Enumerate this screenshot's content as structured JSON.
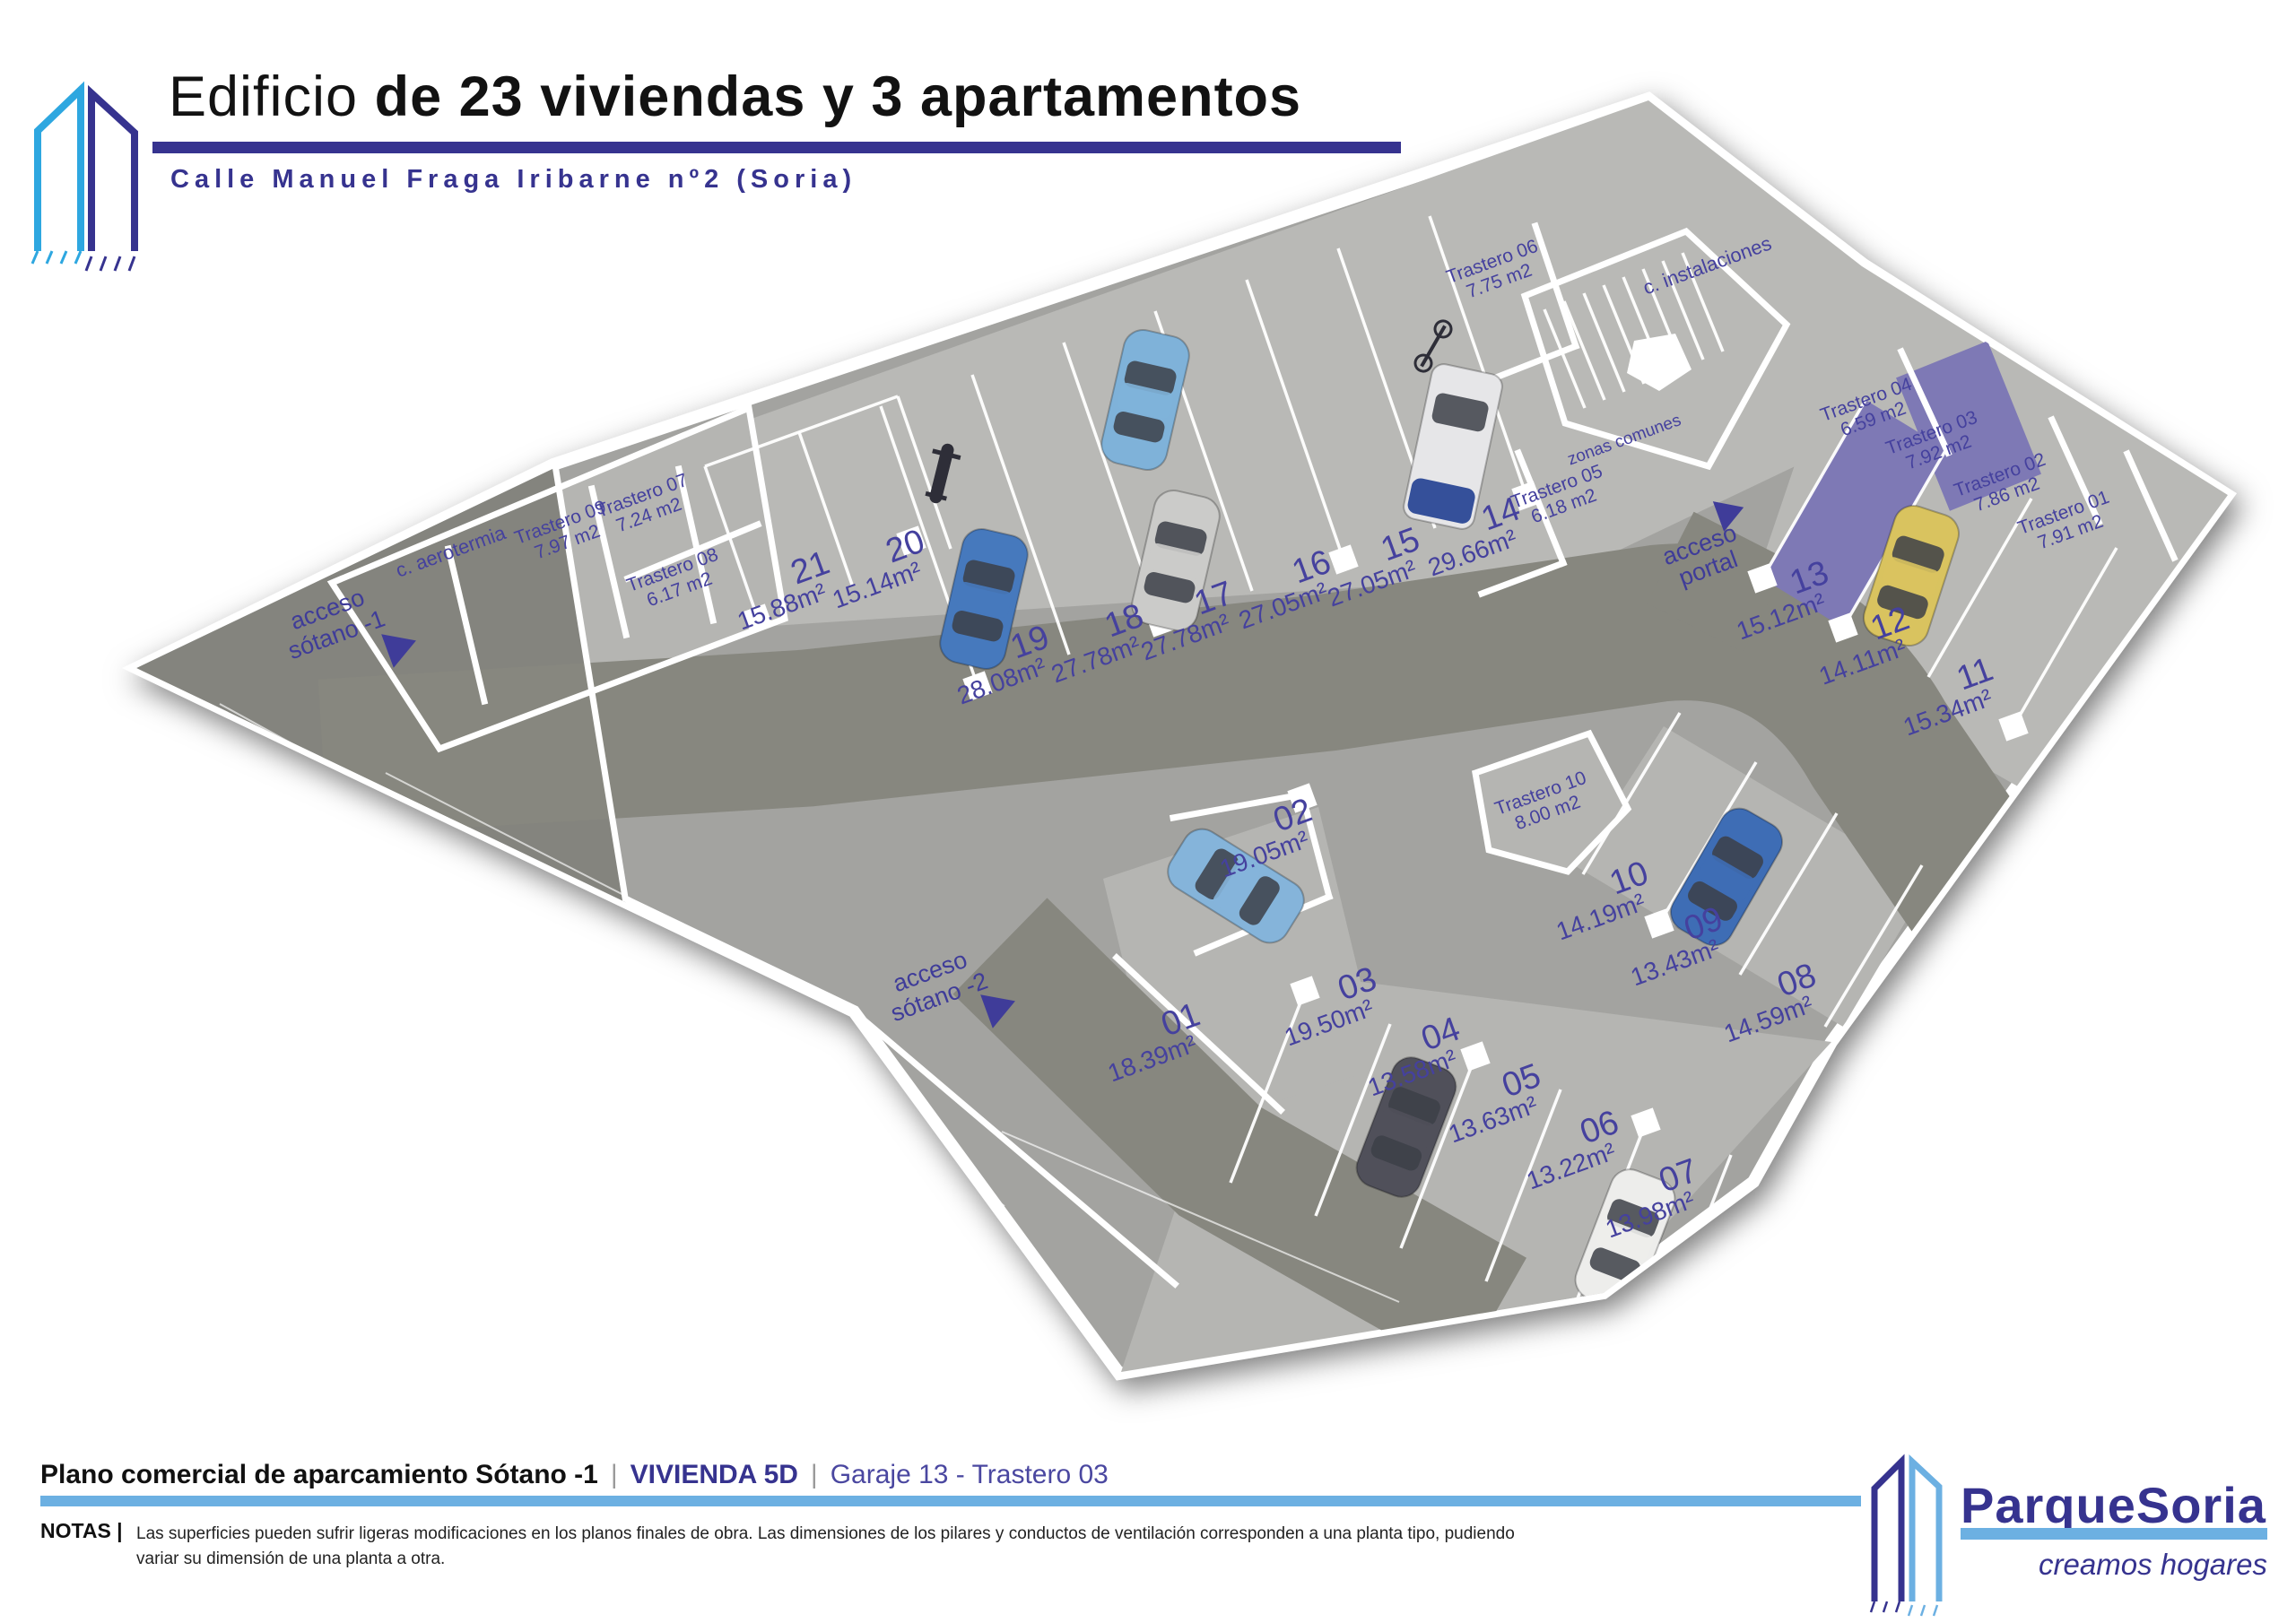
{
  "header": {
    "title_regular": "Edificio ",
    "title_bold": "de 23 viviendas y 3 apartamentos",
    "subtitle": "Calle Manuel Fraga Iribarne nº2 (Soria)"
  },
  "plan": {
    "spots": [
      {
        "id": "01",
        "area": "18.39m²"
      },
      {
        "id": "02",
        "area": "19.05m²"
      },
      {
        "id": "03",
        "area": "19.50m²"
      },
      {
        "id": "04",
        "area": "13.58m²"
      },
      {
        "id": "05",
        "area": "13.63m²"
      },
      {
        "id": "06",
        "area": "13.22m²"
      },
      {
        "id": "07",
        "area": "13.98m²"
      },
      {
        "id": "08",
        "area": "14.59m²"
      },
      {
        "id": "09",
        "area": "13.43m²"
      },
      {
        "id": "10",
        "area": "14.19m²"
      },
      {
        "id": "11",
        "area": "15.34m²"
      },
      {
        "id": "12",
        "area": "14.11m²"
      },
      {
        "id": "13",
        "area": "15.12m²"
      },
      {
        "id": "14",
        "area": "29.66m²"
      },
      {
        "id": "15",
        "area": "27.05m²"
      },
      {
        "id": "16",
        "area": "27.05m²"
      },
      {
        "id": "17",
        "area": "27.78m²"
      },
      {
        "id": "18",
        "area": "27.78m²"
      },
      {
        "id": "19",
        "area": "28.08m²"
      },
      {
        "id": "20",
        "area": "15.14m²"
      },
      {
        "id": "21",
        "area": "15.88m²"
      }
    ],
    "trasteros": [
      {
        "name": "Trastero 01",
        "area": "7.91 m2"
      },
      {
        "name": "Trastero 02",
        "area": "7.86 m2"
      },
      {
        "name": "Trastero 03",
        "area": "7.92 m2"
      },
      {
        "name": "Trastero 04",
        "area": "6.59 m2"
      },
      {
        "name": "Trastero 05",
        "area": "6.18 m2"
      },
      {
        "name": "Trastero 06",
        "area": "7.75 m2"
      },
      {
        "name": "Trastero 07",
        "area": "7.24 m2"
      },
      {
        "name": "Trastero 08",
        "area": "6.17 m2"
      },
      {
        "name": "Trastero 09",
        "area": "7.97 m2"
      },
      {
        "name": "Trastero 10",
        "area": "8.00 m2"
      }
    ],
    "rooms": {
      "aerotermia": "c. aerotermia",
      "instalaciones": "c. instalaciones",
      "zonas": "zonas comunes"
    },
    "access": {
      "sotano1_l1": "acceso",
      "sotano1_l2": "sótano -1",
      "sotano2_l1": "acceso",
      "sotano2_l2": "sótano -2",
      "portal_l1": "acceso",
      "portal_l2": "portal"
    },
    "highlight_color": "#7e79b5"
  },
  "footer": {
    "plan_title": "Plano comercial de aparcamiento Sótano -1",
    "separator": "|",
    "vivienda": "VIVIENDA 5D",
    "detail": "Garaje 13 - Trastero 03",
    "notas_label": "NOTAS |",
    "notas_text": "Las superficies pueden sufrir ligeras modificaciones en los planos finales de obra. Las dimensiones de los pilares y conductos de ventilación corresponden a una planta tipo, pudiendo variar su dimensión de una planta a otra.",
    "brand": "ParqueSoria",
    "brand_tagline": "creamos hogares"
  },
  "colors": {
    "navy": "#36338f",
    "light_blue": "#6cb0e2",
    "logo_blue": "#2ea7e0",
    "label_navy": "#45419e",
    "highlight_purple": "#7e79b5"
  }
}
